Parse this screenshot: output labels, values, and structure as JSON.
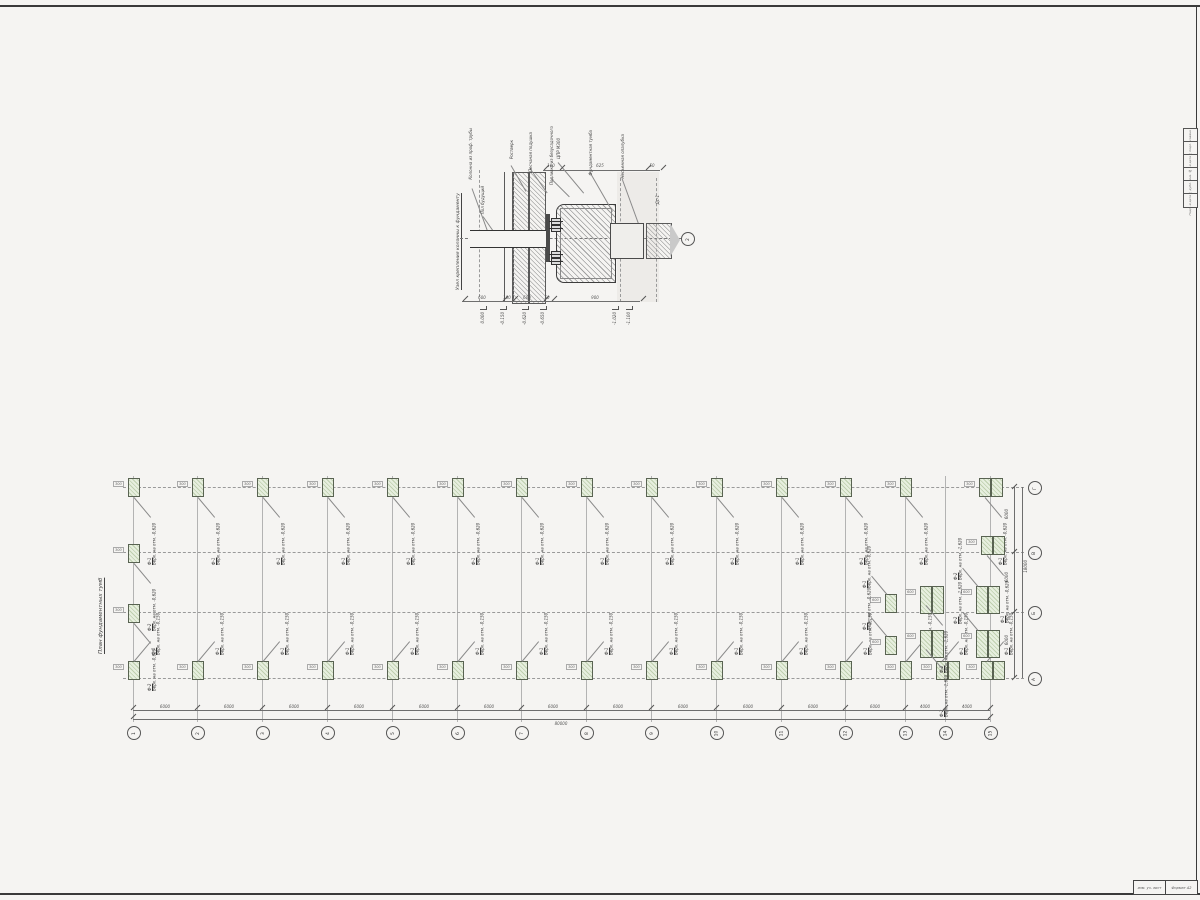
{
  "colors": {
    "paper": "#f5f4f2",
    "ink": "#3c3c3c",
    "thin": "#8b8b8b",
    "green_fill": "#e7efdf",
    "green_stripe": "#becfae",
    "dim_text": "#555555"
  },
  "frame": {
    "strip_rows": [
      {
        "x": 1183,
        "y": 128,
        "t": "Согласовано"
      },
      {
        "x": 1183,
        "y": 141,
        "t": "Инв. № подл."
      },
      {
        "x": 1183,
        "y": 154,
        "t": "Подп. и дата"
      },
      {
        "x": 1183,
        "y": 167,
        "t": "Взам. инв. №"
      },
      {
        "x": 1183,
        "y": 180,
        "t": "Инв. № дубл."
      },
      {
        "x": 1183,
        "y": 193,
        "t": "Подп. и дата"
      }
    ],
    "stamp_left": "изм. уч. лист",
    "stamp_right": "Формат А2"
  },
  "detail": {
    "title": "Узел крепления колонны к фундаменту",
    "axis_bubble": "2",
    "section_mark": "Дс-1",
    "labels": [
      {
        "x": 468,
        "y": 128,
        "t": "Колонна из проф. трубы"
      },
      {
        "x": 480,
        "y": 186,
        "t": "Пол будущий"
      },
      {
        "x": 509,
        "y": 140,
        "t": "Ростверк"
      },
      {
        "x": 528,
        "y": 132,
        "t": "Песчаная подушка"
      },
      {
        "x": 549,
        "y": 126,
        "t": "Подливка из безусадочного"
      },
      {
        "x": 556,
        "y": 138,
        "t": "ЦПР М300"
      },
      {
        "x": 588,
        "y": 130,
        "t": "Фундаментная тумба"
      },
      {
        "x": 620,
        "y": 134,
        "t": "Несъемная опалубка"
      },
      {
        "x": 655,
        "y": 195,
        "t": "Дс-1"
      }
    ],
    "leaders": [
      {
        "x": 472,
        "y": 188,
        "w": 45,
        "r": 70
      },
      {
        "x": 483,
        "y": 216,
        "w": 18,
        "r": 55
      },
      {
        "x": 511,
        "y": 165,
        "w": 30,
        "r": 60
      },
      {
        "x": 530,
        "y": 168,
        "w": 30,
        "r": 55
      },
      {
        "x": 551,
        "y": 178,
        "w": 26,
        "r": 45
      },
      {
        "x": 558,
        "y": 162,
        "w": 40,
        "r": 50
      },
      {
        "x": 590,
        "y": 172,
        "w": 45,
        "r": 60
      },
      {
        "x": 622,
        "y": 178,
        "w": 55,
        "r": 70
      }
    ],
    "top_dims": [
      {
        "x": 551,
        "y": 163,
        "t": "100"
      },
      {
        "x": 600,
        "y": 163,
        "t": "625"
      },
      {
        "x": 652,
        "y": 163,
        "t": "50"
      }
    ],
    "bottom_dims": [
      {
        "x": 482,
        "y": 295,
        "t": "600"
      },
      {
        "x": 507,
        "y": 295,
        "t": "100"
      },
      {
        "x": 527,
        "y": 295,
        "t": "600"
      },
      {
        "x": 547,
        "y": 295,
        "t": "50"
      },
      {
        "x": 595,
        "y": 295,
        "t": "900"
      }
    ],
    "ticks": [
      {
        "x": 543,
        "y": 167
      },
      {
        "x": 559,
        "y": 167
      },
      {
        "x": 645,
        "y": 167
      },
      {
        "x": 660,
        "y": 167
      },
      {
        "x": 462,
        "y": 298
      },
      {
        "x": 502,
        "y": 298
      },
      {
        "x": 512,
        "y": 298
      },
      {
        "x": 543,
        "y": 298
      },
      {
        "x": 551,
        "y": 298
      },
      {
        "x": 640,
        "y": 298
      }
    ],
    "elevations": [
      {
        "x": 480,
        "y": 306,
        "t": "0.000"
      },
      {
        "x": 500,
        "y": 306,
        "t": "-0.150"
      },
      {
        "x": 522,
        "y": 306,
        "t": "-0.620"
      },
      {
        "x": 540,
        "y": 306,
        "t": "-0.650"
      },
      {
        "x": 612,
        "y": 306,
        "t": "-1.020"
      },
      {
        "x": 626,
        "y": 306,
        "t": "-1.100"
      }
    ]
  },
  "plan": {
    "title": "План фундаментных тумб",
    "grid_v": [
      {
        "x": 133,
        "y": 476,
        "h": 246
      },
      {
        "x": 197,
        "y": 476,
        "h": 246
      },
      {
        "x": 262,
        "y": 476,
        "h": 246
      },
      {
        "x": 327,
        "y": 476,
        "h": 246
      },
      {
        "x": 392,
        "y": 476,
        "h": 246
      },
      {
        "x": 457,
        "y": 476,
        "h": 246
      },
      {
        "x": 521,
        "y": 476,
        "h": 246
      },
      {
        "x": 586,
        "y": 476,
        "h": 246
      },
      {
        "x": 651,
        "y": 476,
        "h": 246
      },
      {
        "x": 716,
        "y": 476,
        "h": 246
      },
      {
        "x": 781,
        "y": 476,
        "h": 246
      },
      {
        "x": 845,
        "y": 476,
        "h": 246
      },
      {
        "x": 905,
        "y": 476,
        "h": 246
      },
      {
        "x": 945,
        "y": 476,
        "h": 246
      },
      {
        "x": 990,
        "y": 476,
        "h": 246
      }
    ],
    "rows": [
      {
        "x": 123,
        "y": 487,
        "w": 901
      },
      {
        "x": 123,
        "y": 552,
        "w": 901
      },
      {
        "x": 123,
        "y": 612,
        "w": 901
      },
      {
        "x": 123,
        "y": 678,
        "w": 901
      }
    ],
    "col_bubbles": [
      {
        "x": 127,
        "y": 726,
        "t": "1"
      },
      {
        "x": 191,
        "y": 726,
        "t": "2"
      },
      {
        "x": 256,
        "y": 726,
        "t": "3"
      },
      {
        "x": 321,
        "y": 726,
        "t": "4"
      },
      {
        "x": 386,
        "y": 726,
        "t": "5"
      },
      {
        "x": 451,
        "y": 726,
        "t": "6"
      },
      {
        "x": 515,
        "y": 726,
        "t": "7"
      },
      {
        "x": 580,
        "y": 726,
        "t": "8"
      },
      {
        "x": 645,
        "y": 726,
        "t": "9"
      },
      {
        "x": 710,
        "y": 726,
        "t": "10"
      },
      {
        "x": 775,
        "y": 726,
        "t": "11"
      },
      {
        "x": 839,
        "y": 726,
        "t": "12"
      },
      {
        "x": 899,
        "y": 726,
        "t": "13"
      },
      {
        "x": 939,
        "y": 726,
        "t": "14"
      },
      {
        "x": 984,
        "y": 726,
        "t": "15"
      }
    ],
    "row_bubbles": [
      {
        "x": 1028,
        "y": 672,
        "t": "А"
      },
      {
        "x": 1028,
        "y": 606,
        "t": "Б"
      },
      {
        "x": 1028,
        "y": 546,
        "t": "В"
      },
      {
        "x": 1028,
        "y": 481,
        "t": "Г"
      }
    ],
    "bay_dims": [
      {
        "x": 165,
        "y": 704,
        "t": "6000"
      },
      {
        "x": 229,
        "y": 704,
        "t": "6000"
      },
      {
        "x": 294,
        "y": 704,
        "t": "6000"
      },
      {
        "x": 359,
        "y": 704,
        "t": "6000"
      },
      {
        "x": 424,
        "y": 704,
        "t": "6000"
      },
      {
        "x": 489,
        "y": 704,
        "t": "6000"
      },
      {
        "x": 553,
        "y": 704,
        "t": "6000"
      },
      {
        "x": 618,
        "y": 704,
        "t": "6000"
      },
      {
        "x": 683,
        "y": 704,
        "t": "6000"
      },
      {
        "x": 748,
        "y": 704,
        "t": "6000"
      },
      {
        "x": 813,
        "y": 704,
        "t": "6000"
      },
      {
        "x": 875,
        "y": 704,
        "t": "6000"
      },
      {
        "x": 925,
        "y": 704,
        "t": "4000"
      },
      {
        "x": 967,
        "y": 704,
        "t": "4000"
      }
    ],
    "total_dim": "80000",
    "bay_ticks": [
      {
        "x": 130,
        "y": 707
      },
      {
        "x": 194,
        "y": 707
      },
      {
        "x": 259,
        "y": 707
      },
      {
        "x": 324,
        "y": 707
      },
      {
        "x": 389,
        "y": 707
      },
      {
        "x": 454,
        "y": 707
      },
      {
        "x": 518,
        "y": 707
      },
      {
        "x": 583,
        "y": 707
      },
      {
        "x": 648,
        "y": 707
      },
      {
        "x": 713,
        "y": 707
      },
      {
        "x": 778,
        "y": 707
      },
      {
        "x": 842,
        "y": 707
      },
      {
        "x": 902,
        "y": 707
      },
      {
        "x": 942,
        "y": 707
      },
      {
        "x": 987,
        "y": 707
      },
      {
        "x": 130,
        "y": 716
      },
      {
        "x": 987,
        "y": 716
      }
    ],
    "right_dims": [
      {
        "x": 1004,
        "y": 509,
        "t": "6000"
      },
      {
        "x": 1004,
        "y": 572,
        "t": "6000"
      },
      {
        "x": 1004,
        "y": 635,
        "t": "6000"
      }
    ],
    "right_total": "18000",
    "right_ticks": [
      {
        "x": 1011,
        "y": 486
      },
      {
        "x": 1011,
        "y": 551
      },
      {
        "x": 1011,
        "y": 611
      },
      {
        "x": 1011,
        "y": 677
      }
    ],
    "footings": [
      {
        "x": 128,
        "y": 478,
        "cls": "ld",
        "nm": "Ф-1",
        "el": "Верх. на отм. -0,620",
        "mini": "300"
      },
      {
        "x": 192,
        "y": 478,
        "cls": "ld",
        "nm": "Ф-1",
        "el": "Верх. на отм. -0,620",
        "mini": "300"
      },
      {
        "x": 257,
        "y": 478,
        "cls": "ld",
        "nm": "Ф-1",
        "el": "Верх. на отм. -0,620",
        "mini": "300"
      },
      {
        "x": 322,
        "y": 478,
        "cls": "ld",
        "nm": "Ф-1",
        "el": "Верх. на отм. -0,620",
        "mini": "300"
      },
      {
        "x": 387,
        "y": 478,
        "cls": "ld",
        "nm": "Ф-1",
        "el": "Верх. на отм. -0,620",
        "mini": "300"
      },
      {
        "x": 452,
        "y": 478,
        "cls": "ld",
        "nm": "Ф-1",
        "el": "Верх. на отм. -0,620",
        "mini": "300"
      },
      {
        "x": 516,
        "y": 478,
        "cls": "ld",
        "nm": "Ф-1",
        "el": "Верх. на отм. -0,620",
        "mini": "300"
      },
      {
        "x": 581,
        "y": 478,
        "cls": "ld",
        "nm": "Ф-1",
        "el": "Верх. на отм. -0,620",
        "mini": "300"
      },
      {
        "x": 646,
        "y": 478,
        "cls": "ld",
        "nm": "Ф-1",
        "el": "Верх. на отм. -0,620",
        "mini": "300"
      },
      {
        "x": 711,
        "y": 478,
        "cls": "ld",
        "nm": "Ф-1",
        "el": "Верх. на отм. -0,620",
        "mini": "300"
      },
      {
        "x": 776,
        "y": 478,
        "cls": "ld",
        "nm": "Ф-1",
        "el": "Верх. на отм. -0,620",
        "mini": "300"
      },
      {
        "x": 840,
        "y": 478,
        "cls": "ld",
        "nm": "Ф-1",
        "el": "Верх. на отм. -0,620",
        "mini": "300"
      },
      {
        "x": 900,
        "y": 478,
        "cls": "ld",
        "nm": "Ф-1",
        "el": "Верх. на отм. -0,620",
        "mini": "300"
      },
      {
        "x": 979,
        "y": 478,
        "cls": "ld pair",
        "nm": "Ф-1",
        "el": "Верх. на отм. -0,620",
        "mini": "300"
      },
      {
        "x": 128,
        "y": 661,
        "cls": "up",
        "nm": "Ф-1",
        "el": "Верх. на отм. -0,150",
        "mini": "300"
      },
      {
        "x": 192,
        "y": 661,
        "cls": "up",
        "nm": "Ф-1",
        "el": "Верх. на отм. -0,150",
        "mini": "300"
      },
      {
        "x": 257,
        "y": 661,
        "cls": "up",
        "nm": "Ф-1",
        "el": "Верх. на отм. -0,150",
        "mini": "300"
      },
      {
        "x": 322,
        "y": 661,
        "cls": "up",
        "nm": "Ф-1",
        "el": "Верх. на отм. -0,150",
        "mini": "300"
      },
      {
        "x": 387,
        "y": 661,
        "cls": "up",
        "nm": "Ф-1",
        "el": "Верх. на отм. -0,150",
        "mini": "300"
      },
      {
        "x": 452,
        "y": 661,
        "cls": "up",
        "nm": "Ф-1",
        "el": "Верх. на отм. -0,150",
        "mini": "300"
      },
      {
        "x": 516,
        "y": 661,
        "cls": "up",
        "nm": "Ф-1",
        "el": "Верх. на отм. -0,150",
        "mini": "300"
      },
      {
        "x": 581,
        "y": 661,
        "cls": "up",
        "nm": "Ф-1",
        "el": "Верх. на отм. -0,150",
        "mini": "300"
      },
      {
        "x": 646,
        "y": 661,
        "cls": "up",
        "nm": "Ф-1",
        "el": "Верх. на отм. -0,150",
        "mini": "300"
      },
      {
        "x": 711,
        "y": 661,
        "cls": "up",
        "nm": "Ф-1",
        "el": "Верх. на отм. -0,150",
        "mini": "300"
      },
      {
        "x": 776,
        "y": 661,
        "cls": "up",
        "nm": "Ф-1",
        "el": "Верх. на отм. -0,150",
        "mini": "300"
      },
      {
        "x": 840,
        "y": 661,
        "cls": "up",
        "nm": "Ф-1",
        "el": "Верх. на отм. -0,150",
        "mini": "300"
      },
      {
        "x": 900,
        "y": 661,
        "cls": "up",
        "nm": "Ф-1",
        "el": "Верх. на отм. -0,150",
        "mini": "300"
      },
      {
        "x": 936,
        "y": 661,
        "cls": "up pair",
        "nm": "Ф-1",
        "el": "Верх. на отм. -0,150",
        "mini": "300"
      },
      {
        "x": 981,
        "y": 661,
        "cls": "up pair",
        "nm": "Ф-1",
        "el": "Верх. на отм. -0,150",
        "mini": "300"
      },
      {
        "x": 128,
        "y": 544,
        "cls": "ld",
        "nm": "Ф-2",
        "el": "Верх. на отм. -0,620",
        "mini": "300"
      },
      {
        "x": 128,
        "y": 604,
        "cls": "ld",
        "nm": "Ф-2",
        "el": "Верх. на отм. -0,620",
        "mini": "300"
      },
      {
        "x": 885,
        "y": 594,
        "cls": "ul",
        "nm": "Ф-1",
        "el": "Верх. на отм. -0,620",
        "mini": "600"
      },
      {
        "x": 885,
        "y": 636,
        "cls": "ul",
        "nm": "Ф-1",
        "el": "Верх. на отм. -0,620",
        "mini": "600"
      },
      {
        "x": 920,
        "y": 586,
        "cls": "ld pair tall",
        "nm": "Ф-2",
        "el": "Верх. на отм. -1,620",
        "mini": "600"
      },
      {
        "x": 920,
        "y": 630,
        "cls": "ld pair tall",
        "nm": "Ф-2",
        "el": "Верх. на отм. -1,620",
        "mini": "600"
      },
      {
        "x": 976,
        "y": 586,
        "cls": "ul pair tall",
        "nm": "Ф-2",
        "el": "Верх. на отм. -1,620",
        "mini": "600"
      },
      {
        "x": 976,
        "y": 630,
        "cls": "ul pair tall",
        "nm": "Ф-2",
        "el": "Верх. на отм. -1,620",
        "mini": "600"
      },
      {
        "x": 981,
        "y": 536,
        "cls": "ld pair",
        "nm": "Ф-1",
        "el": "Верх. на отм. -0,620",
        "mini": "300"
      }
    ]
  }
}
